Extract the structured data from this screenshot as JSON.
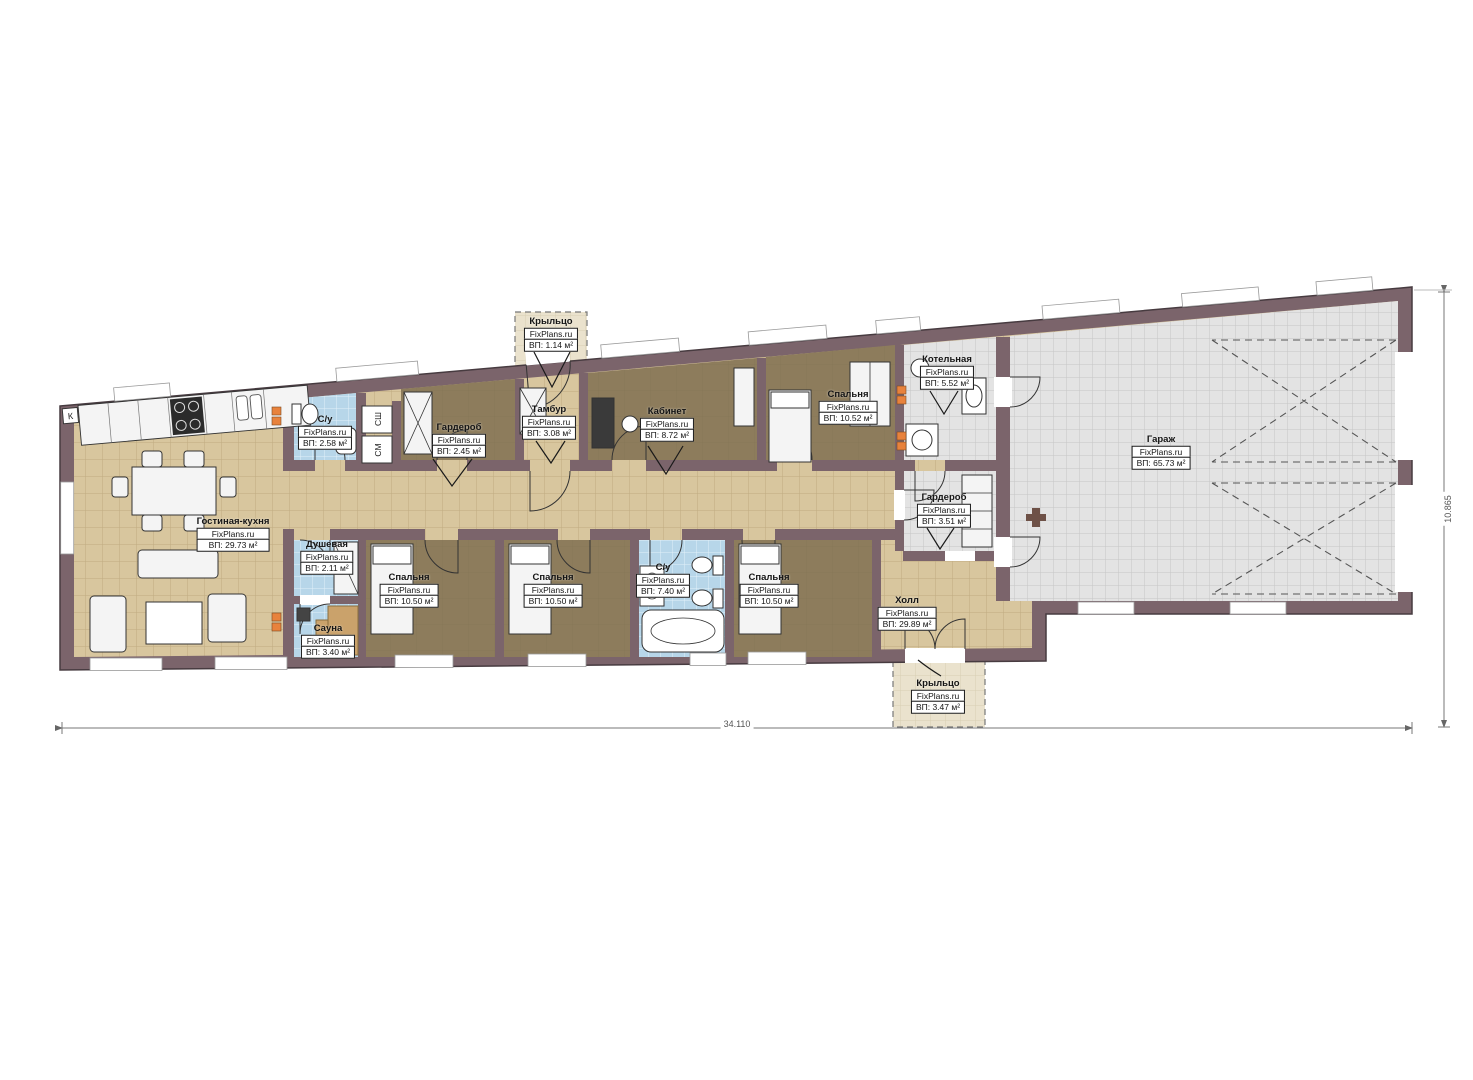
{
  "palette": {
    "wall": "#7b646b",
    "wall_edge": "#473b40",
    "floor_beige": "#d8c69e",
    "beige_line": "#bfab80",
    "floor_brown": "#8d7c5c",
    "brown_line": "#80704f",
    "floor_blue": "#b7d6e9",
    "blue_line": "#e2f0f9",
    "floor_gray": "#e3e3e3",
    "gray_line": "#c6c6c6",
    "porch": "#eae2cd",
    "porch_line": "#d8cfb2",
    "furn": "#f4f4f4",
    "outline": "#2e2e2e",
    "radiator": "#e8823c",
    "dim": "#6f6f6f",
    "label_border": "#1a1a1a"
  },
  "brand_label": "FixPlans.ru",
  "rooms": [
    {
      "name": "Гостиная-кухня",
      "area": "ВП: 29.73 м²"
    },
    {
      "name": "С/у",
      "area": "ВП: 2.58 м²"
    },
    {
      "name": "Гардероб",
      "area": "ВП: 2.45 м²"
    },
    {
      "name": "Крыльцо",
      "area": "ВП: 1.14 м²"
    },
    {
      "name": "Тамбур",
      "area": "ВП: 3.08 м²"
    },
    {
      "name": "Кабинет",
      "area": "ВП: 8.72 м²"
    },
    {
      "name": "Спальня",
      "area": "ВП: 10.52 м²"
    },
    {
      "name": "Котельная",
      "area": "ВП: 5.52 м²"
    },
    {
      "name": "Гардероб",
      "area": "ВП: 3.51 м²"
    },
    {
      "name": "Гараж",
      "area": "ВП: 65.73 м²"
    },
    {
      "name": "Душевая",
      "area": "ВП: 2.11 м²"
    },
    {
      "name": "Сауна",
      "area": "ВП: 3.40 м²"
    },
    {
      "name": "Спальня",
      "area": "ВП: 10.50 м²"
    },
    {
      "name": "Спальня",
      "area": "ВП: 10.50 м²"
    },
    {
      "name": "С/у",
      "area": "ВП: 7.40 м²"
    },
    {
      "name": "Спальня",
      "area": "ВП: 10.50 м²"
    },
    {
      "name": "Холл",
      "area": "ВП: 29.89 м²"
    },
    {
      "name": "Крыльцо",
      "area": "ВП: 3.47 м²"
    }
  ],
  "appliances": {
    "dryer": "СШ",
    "washer": "СМ",
    "fridge": "К"
  },
  "dimensions": {
    "length": "34.110",
    "depth": "10.865"
  }
}
